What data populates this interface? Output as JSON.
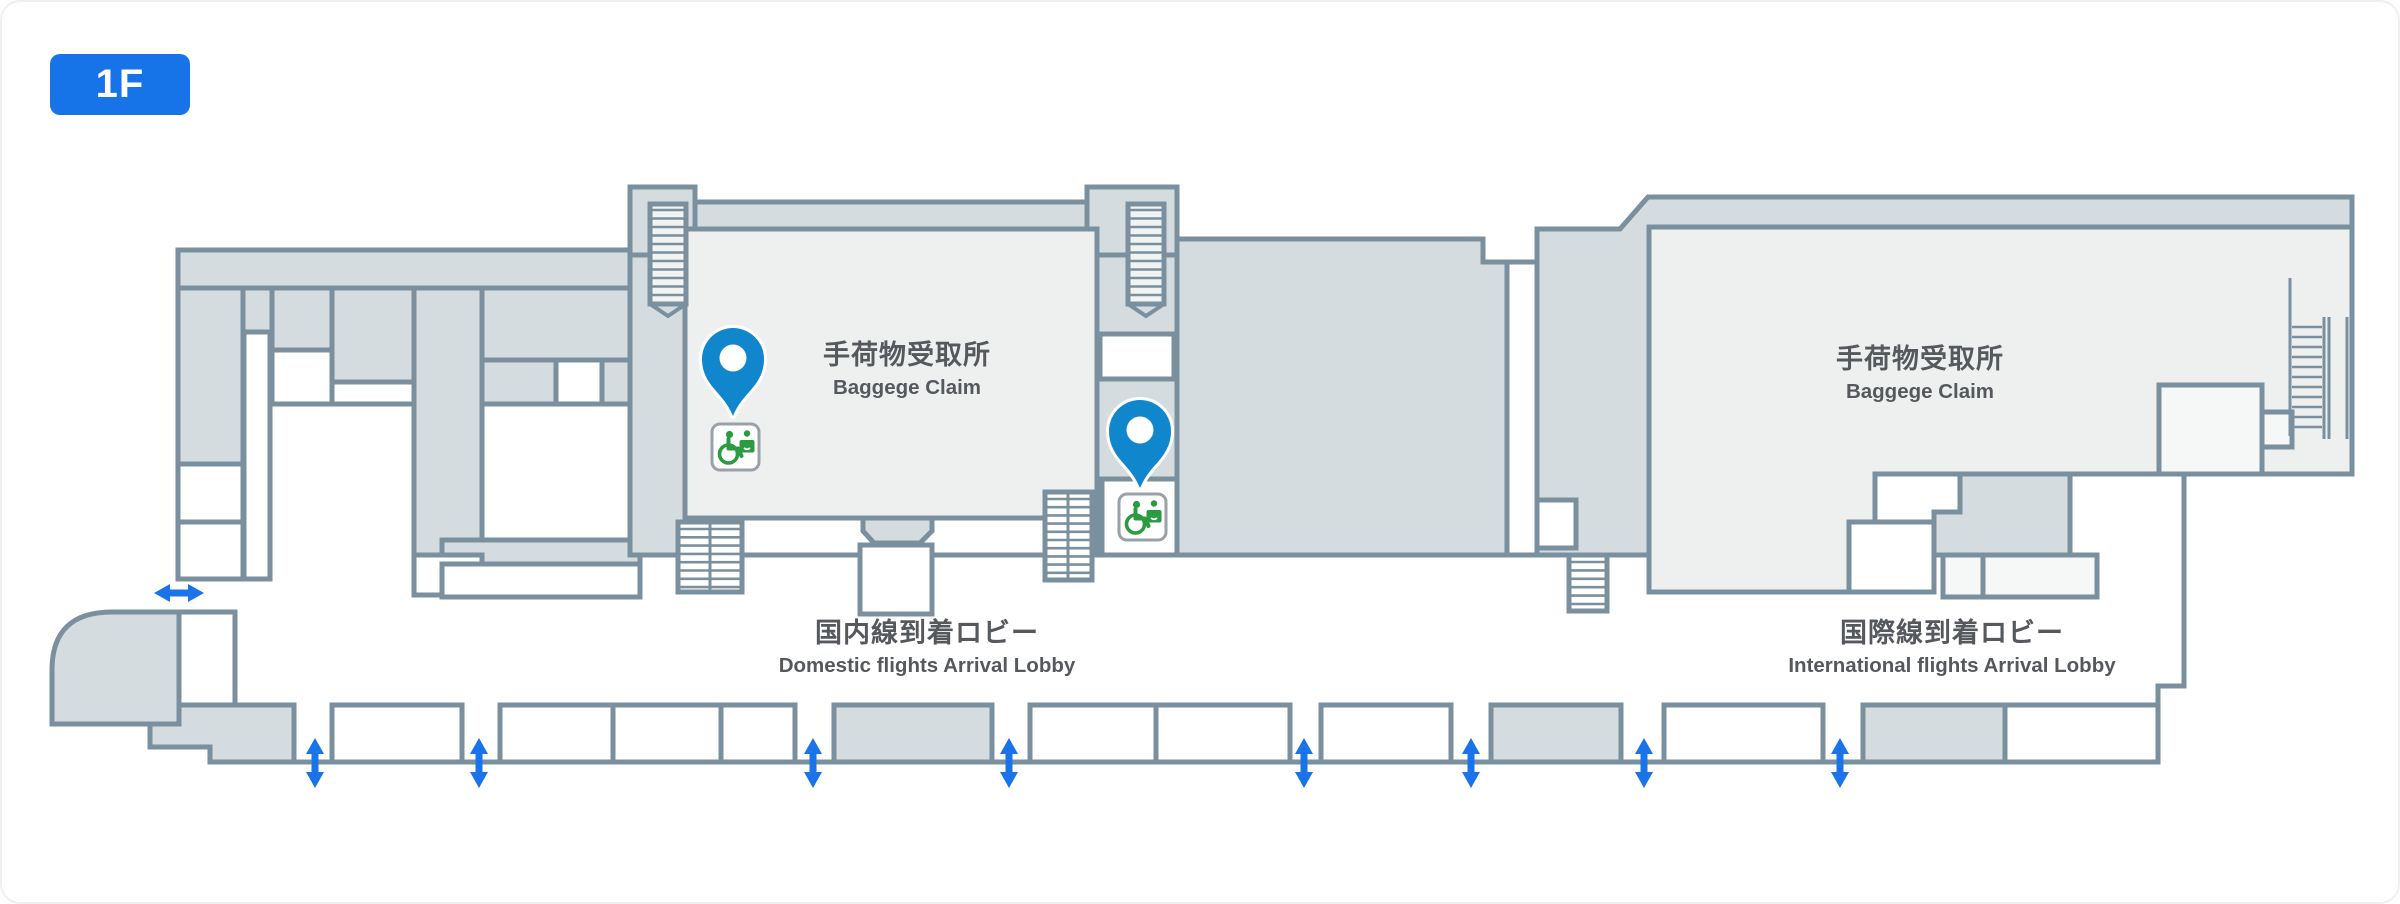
{
  "floor_badge": {
    "label": "1F"
  },
  "colors": {
    "wall": "#7b909e",
    "room_gray": "#d4dce0",
    "room_light": "#eef0f0",
    "room_faint": "#f6f7f7",
    "pin_blue": "#1086cd",
    "arrow_blue": "#1a73e8",
    "badge_blue": "#1774e8",
    "icon_green": "#2a9b41",
    "icon_border": "#9aa1a8",
    "text": "#55595d"
  },
  "labels": {
    "domestic_baggage": {
      "jp": "手荷物受取所",
      "en": "Baggege Claim",
      "x": 905,
      "y": 336
    },
    "international_baggage": {
      "jp": "手荷物受取所",
      "en": "Baggege Claim",
      "x": 1918,
      "y": 340
    },
    "domestic_lobby": {
      "jp": "国内線到着ロビー",
      "en": "Domestic flights Arrival Lobby",
      "x": 925,
      "y": 614
    },
    "international_lobby": {
      "jp": "国際線到着ロビー",
      "en": "International flights Arrival Lobby",
      "x": 1950,
      "y": 614
    }
  },
  "markers": [
    {
      "name": "accessible-toilet-1",
      "pin": {
        "x": 731,
        "y": 414
      },
      "icon": {
        "x": 710,
        "y": 422
      }
    },
    {
      "name": "accessible-toilet-2",
      "pin": {
        "x": 1138,
        "y": 486
      },
      "icon": {
        "x": 1117,
        "y": 492
      }
    }
  ],
  "entrances": {
    "vertical_arrow_xs": [
      313,
      477,
      811,
      1007,
      1302,
      1469,
      1642,
      1838
    ],
    "vertical_arrow_y": 761,
    "horizontal_arrow": {
      "x": 177,
      "y": 591
    }
  }
}
